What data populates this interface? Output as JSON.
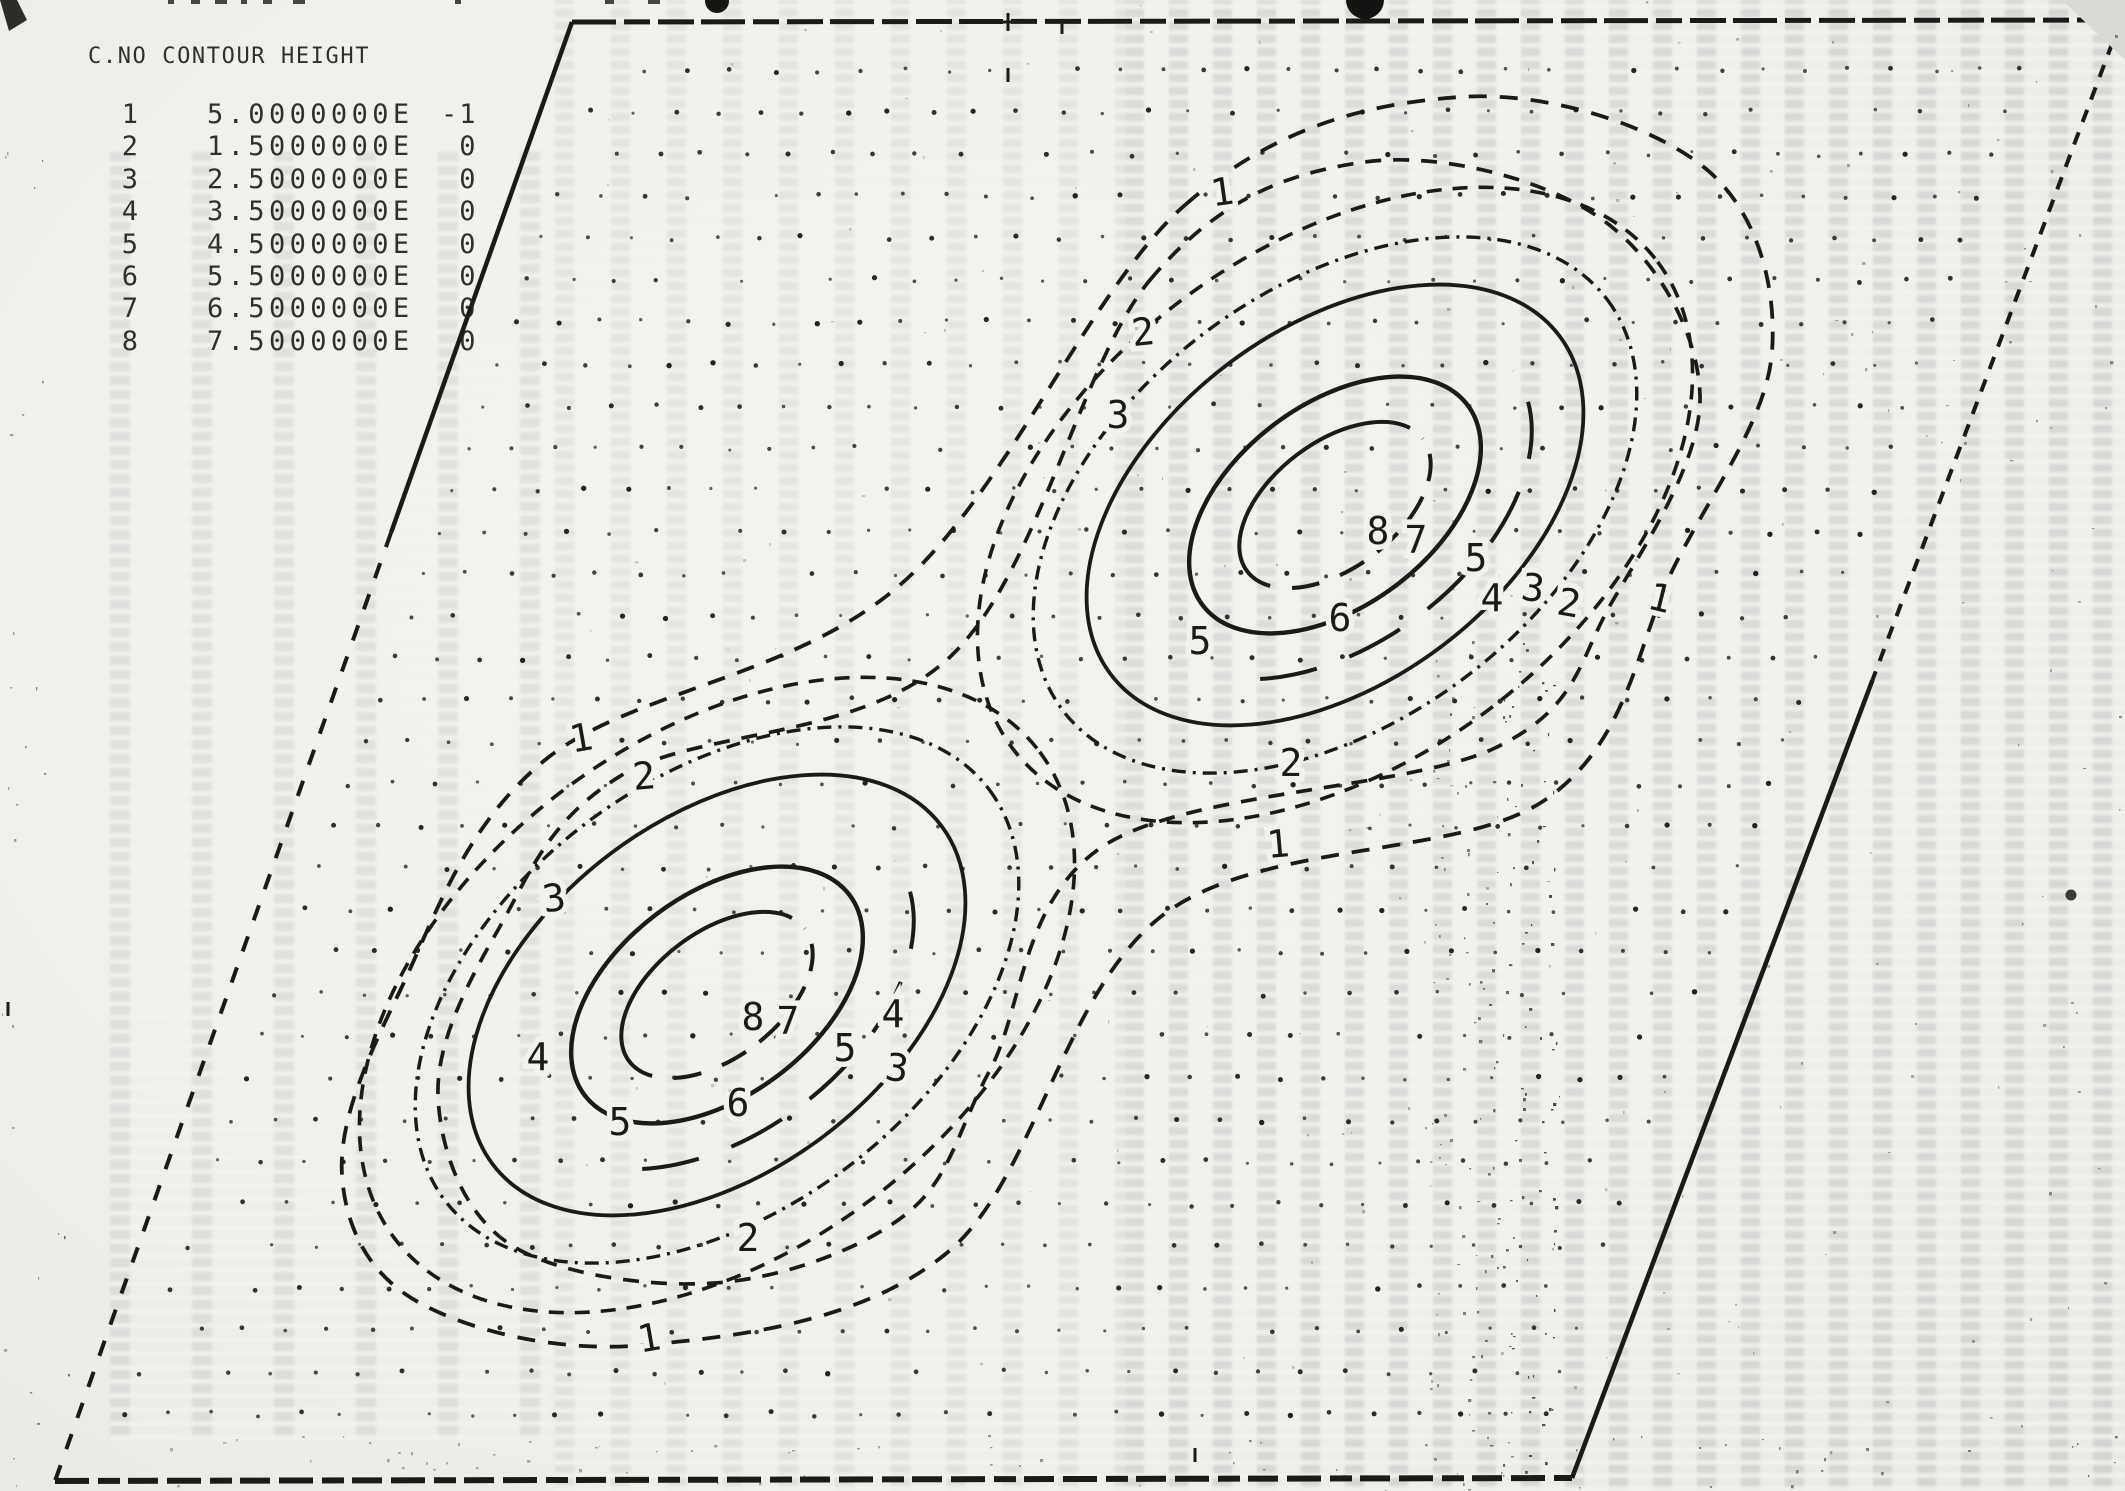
{
  "page": {
    "paper_color": "#f2f1ed",
    "ink_color": "#1b1a18"
  },
  "legend": {
    "title": "C.NO CONTOUR HEIGHT",
    "rows": [
      {
        "no": "1",
        "mantissa": "5.0000000E",
        "exponent": "-1"
      },
      {
        "no": "2",
        "mantissa": "1.5000000E",
        "exponent": "0"
      },
      {
        "no": "3",
        "mantissa": "2.5000000E",
        "exponent": "0"
      },
      {
        "no": "4",
        "mantissa": "3.5000000E",
        "exponent": "0"
      },
      {
        "no": "5",
        "mantissa": "4.5000000E",
        "exponent": "0"
      },
      {
        "no": "6",
        "mantissa": "5.5000000E",
        "exponent": "0"
      },
      {
        "no": "7",
        "mantissa": "6.5000000E",
        "exponent": "0"
      },
      {
        "no": "8",
        "mantissa": "7.5000000E",
        "exponent": "0"
      }
    ]
  },
  "chart_data": {
    "type": "contour",
    "title": "",
    "legend_title": "C.NO CONTOUR HEIGHT",
    "legend_position": "top-left",
    "grid": "sheared dot lattice inside parallelogram frame",
    "levels": [
      {
        "no": 1,
        "height": 0.5,
        "height_label": "5.0000000E -1",
        "line_style": "dashed"
      },
      {
        "no": 2,
        "height": 1.5,
        "height_label": "1.5000000E 0",
        "line_style": "dashed"
      },
      {
        "no": 3,
        "height": 2.5,
        "height_label": "2.5000000E 0",
        "line_style": "dashed"
      },
      {
        "no": 4,
        "height": 3.5,
        "height_label": "3.5000000E 0",
        "line_style": "dash-dot"
      },
      {
        "no": 5,
        "height": 4.5,
        "height_label": "4.5000000E 0",
        "line_style": "solid"
      },
      {
        "no": 6,
        "height": 5.5,
        "height_label": "5.5000000E 0",
        "line_style": "solid-partial-dash"
      },
      {
        "no": 7,
        "height": 6.5,
        "height_label": "6.5000000E 0",
        "line_style": "solid"
      },
      {
        "no": 8,
        "height": 7.5,
        "height_label": "7.5000000E 0",
        "line_style": "solid-partial-dash"
      }
    ],
    "peaks": [
      {
        "name": "upper-right-peak",
        "cx": 1335,
        "cy": 505
      },
      {
        "name": "lower-left-peak",
        "cx": 717,
        "cy": 995
      }
    ],
    "ellipse_rotation_deg": -37,
    "ellipse_levels": [
      {
        "level": 3,
        "rx": 404,
        "ry": 256,
        "w": 3.6,
        "dash": "15 11"
      },
      {
        "level": 4,
        "rx": 341,
        "ry": 216,
        "w": 3.4,
        "dash": "14 7 3 7"
      },
      {
        "level": 5,
        "rx": 281,
        "ry": 177,
        "w": 3.8,
        "dash": null
      },
      {
        "level": 6,
        "rx": 223,
        "ry": 139,
        "w": 4.0,
        "dash": "60 3 5 3 5 3 5 3 5 3 5",
        "pathLength": 100,
        "dashOffset": 60
      },
      {
        "level": 7,
        "rx": 166,
        "ry": 101,
        "w": 4.4,
        "dash": null
      },
      {
        "level": 8,
        "rx": 110,
        "ry": 63,
        "w": 4.0,
        "dash": "52 3 5 3 5 3 5 3 5 4 5 4",
        "pathLength": 100,
        "dashOffset": 52
      }
    ],
    "peanut_levels": [
      {
        "level": 1,
        "w": 3.8,
        "dash": "18 13",
        "points": [
          [
            1185,
            205
          ],
          [
            1460,
            97
          ],
          [
            1705,
            168
          ],
          [
            1772,
            352
          ],
          [
            1675,
            565
          ],
          [
            1545,
            800
          ],
          [
            1163,
            915
          ],
          [
            948,
            1252
          ],
          [
            645,
            1345
          ],
          [
            418,
            1302
          ],
          [
            342,
            1175
          ],
          [
            398,
            995
          ],
          [
            545,
            760
          ],
          [
            900,
            585
          ]
        ]
      },
      {
        "level": 2,
        "w": 3.7,
        "dash": "16 12",
        "points": [
          [
            1150,
            280
          ],
          [
            1365,
            162
          ],
          [
            1600,
            218
          ],
          [
            1700,
            395
          ],
          [
            1612,
            602
          ],
          [
            1495,
            748
          ],
          [
            1105,
            845
          ],
          [
            990,
            1070
          ],
          [
            905,
            1215
          ],
          [
            715,
            1283
          ],
          [
            508,
            1243
          ],
          [
            438,
            1095
          ],
          [
            498,
            930
          ],
          [
            622,
            775
          ],
          [
            950,
            657
          ]
        ]
      }
    ],
    "frame": {
      "tl": [
        572,
        22
      ],
      "tr": [
        2121,
        20
      ],
      "br": [
        1572,
        1478
      ],
      "bl": [
        55,
        1481
      ]
    },
    "grid_dots": {
      "row_step": 42,
      "col_step": 43,
      "inset": 48,
      "dot_radius": 2.1,
      "y_start": 70,
      "y_end": 1445
    },
    "contour_labels": [
      {
        "t": "1",
        "x": 1222,
        "y": 192,
        "r": -8
      },
      {
        "t": "2",
        "x": 1143,
        "y": 332,
        "r": -6
      },
      {
        "t": "3",
        "x": 1118,
        "y": 415,
        "r": 0
      },
      {
        "t": "5",
        "x": 1200,
        "y": 641,
        "r": 0
      },
      {
        "t": "6",
        "x": 1340,
        "y": 618,
        "r": 0
      },
      {
        "t": "8",
        "x": 1378,
        "y": 531,
        "r": 0
      },
      {
        "t": "7",
        "x": 1416,
        "y": 540,
        "r": 0
      },
      {
        "t": "5",
        "x": 1476,
        "y": 558,
        "r": 0
      },
      {
        "t": "4",
        "x": 1492,
        "y": 598,
        "r": 0
      },
      {
        "t": "3",
        "x": 1533,
        "y": 588,
        "r": 8
      },
      {
        "t": "2",
        "x": 1569,
        "y": 603,
        "r": 10
      },
      {
        "t": "1",
        "x": 1660,
        "y": 598,
        "r": 14
      },
      {
        "t": "2",
        "x": 1291,
        "y": 763,
        "r": 0
      },
      {
        "t": "1",
        "x": 1278,
        "y": 844,
        "r": -5
      },
      {
        "t": "1",
        "x": 581,
        "y": 738,
        "r": -10
      },
      {
        "t": "2",
        "x": 644,
        "y": 776,
        "r": -5
      },
      {
        "t": "3",
        "x": 554,
        "y": 898,
        "r": -8
      },
      {
        "t": "4",
        "x": 538,
        "y": 1057,
        "r": 0
      },
      {
        "t": "5",
        "x": 620,
        "y": 1122,
        "r": 0
      },
      {
        "t": "8",
        "x": 753,
        "y": 1017,
        "r": 0
      },
      {
        "t": "7",
        "x": 788,
        "y": 1021,
        "r": 0
      },
      {
        "t": "5",
        "x": 845,
        "y": 1048,
        "r": 0
      },
      {
        "t": "4",
        "x": 893,
        "y": 1014,
        "r": 0
      },
      {
        "t": "3",
        "x": 897,
        "y": 1068,
        "r": 8
      },
      {
        "t": "6",
        "x": 738,
        "y": 1103,
        "r": 0
      },
      {
        "t": "2",
        "x": 748,
        "y": 1238,
        "r": 0
      },
      {
        "t": "1",
        "x": 649,
        "y": 1338,
        "r": -10
      }
    ]
  }
}
